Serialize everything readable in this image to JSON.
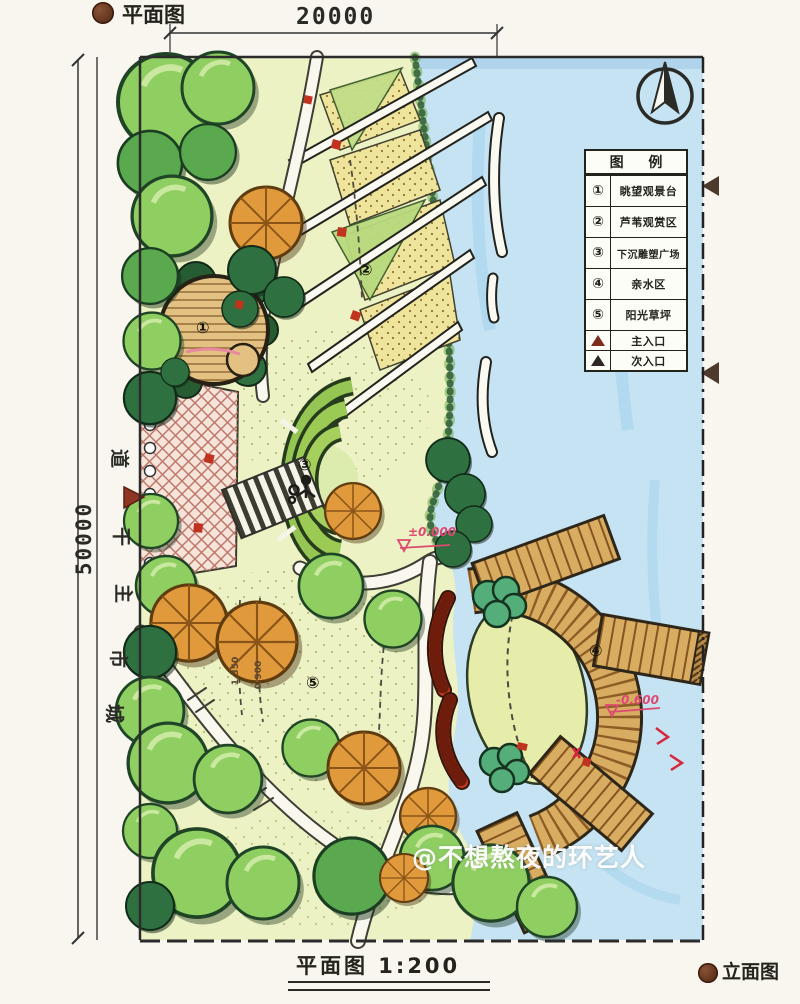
{
  "header": {
    "plan_label": "平面图"
  },
  "dimensions": {
    "width_label": "20000",
    "height_label": "50000"
  },
  "road": {
    "c1": "道",
    "c2": "干",
    "c3": "主",
    "c4": "市",
    "c5": "城"
  },
  "legend": {
    "title": "图 例",
    "items": [
      {
        "symbol": "①",
        "label": "眺望观景台"
      },
      {
        "symbol": "②",
        "label": "芦苇观赏区"
      },
      {
        "symbol": "③",
        "label": "下沉雕塑广场"
      },
      {
        "symbol": "④",
        "label": "亲水区"
      },
      {
        "symbol": "⑤",
        "label": "阳光草坪"
      }
    ],
    "entrances": [
      {
        "label": "主入口"
      },
      {
        "label": "次入口"
      }
    ]
  },
  "markers": {
    "viewing_platform": "①",
    "reed_area": "②",
    "sunken_plaza": "③",
    "waterfront": "④",
    "lawn": "⑤"
  },
  "annotations": {
    "level_zero": "±0.000",
    "level_neg": "-0.600",
    "level_a": "1.350",
    "level_b": "0.900"
  },
  "footer": {
    "scale_label": "平面图 1:200",
    "elevation_label": "立面图"
  },
  "watermark": "@不想熬夜的环艺人",
  "colors": {
    "water": "#c6e3f3",
    "wood": "#d8ad62",
    "accent_red": "#c0341f",
    "annotation_pink": "#dd4a70",
    "entrance_main": "#7e2c1e",
    "entrance_secondary": "#2e2620"
  }
}
